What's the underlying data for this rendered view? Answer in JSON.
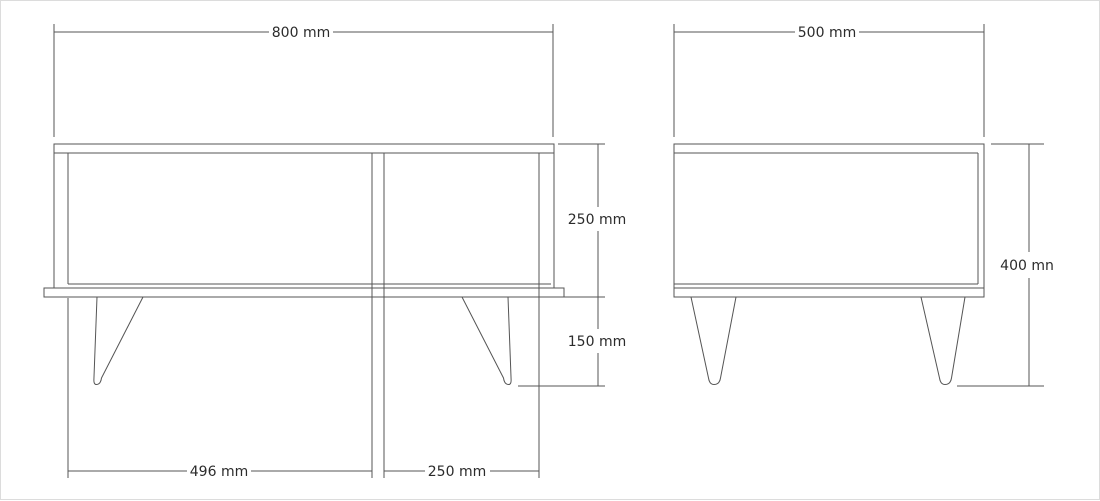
{
  "colors": {
    "line": "#555555",
    "text": "#2b2b2b",
    "background": "#ffffff"
  },
  "front_view": {
    "width_label": "800 mm",
    "body_height_label": "250 mm",
    "leg_height_label": "150 mm",
    "left_section_label": "496 mm",
    "right_section_label": "250 mm"
  },
  "side_view": {
    "width_label": "500 mm",
    "height_label": "400 mn"
  }
}
